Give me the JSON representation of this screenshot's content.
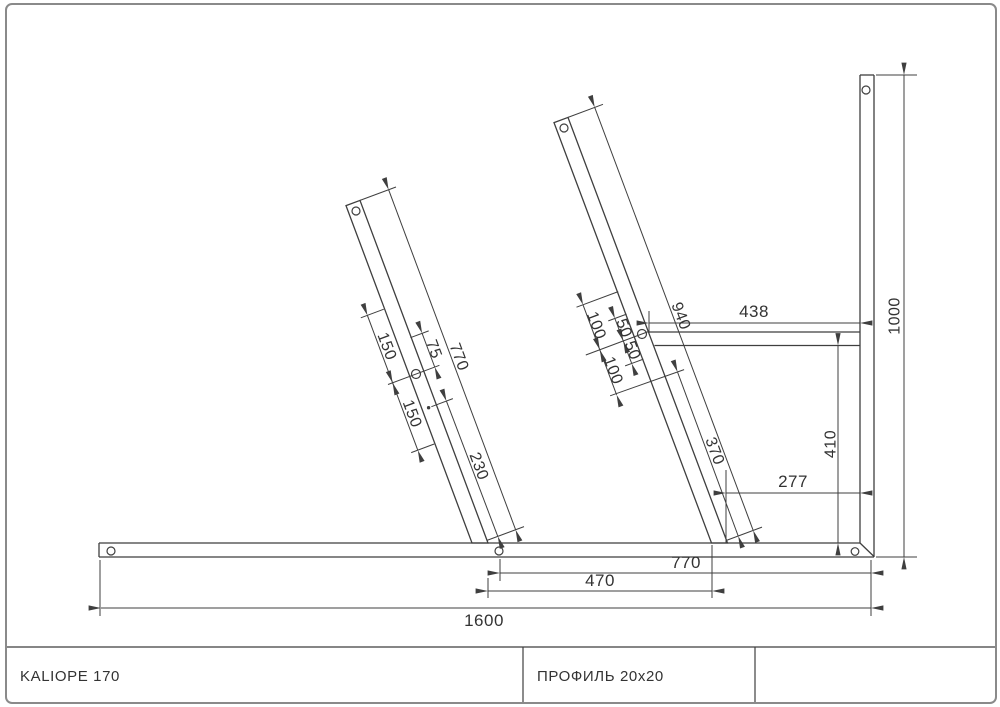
{
  "colors": {
    "line": "#3f3f3f",
    "border": "#8a8a8a",
    "text": "#333333"
  },
  "title_block": {
    "model": "KALIOPE 170",
    "profile": "ПРОФИЛЬ 20x20"
  },
  "dims": {
    "left_beam": {
      "length": "770",
      "upper_spacing": "150",
      "mid_spacing": "75",
      "lower_spacing": "150",
      "bottom_segment": "230"
    },
    "right_beam": {
      "length": "940",
      "upper_100": "100",
      "upper_50": "50",
      "lower_50": "50",
      "lower_100": "100",
      "bottom_segment": "370"
    },
    "top_rail": {
      "length": "438"
    },
    "post": {
      "height": "1000"
    },
    "clearances": {
      "rail_to_base": "410",
      "beam_to_post": "277"
    },
    "base": {
      "overall": "1600",
      "right_segment": "770",
      "beam_gap": "470"
    }
  }
}
